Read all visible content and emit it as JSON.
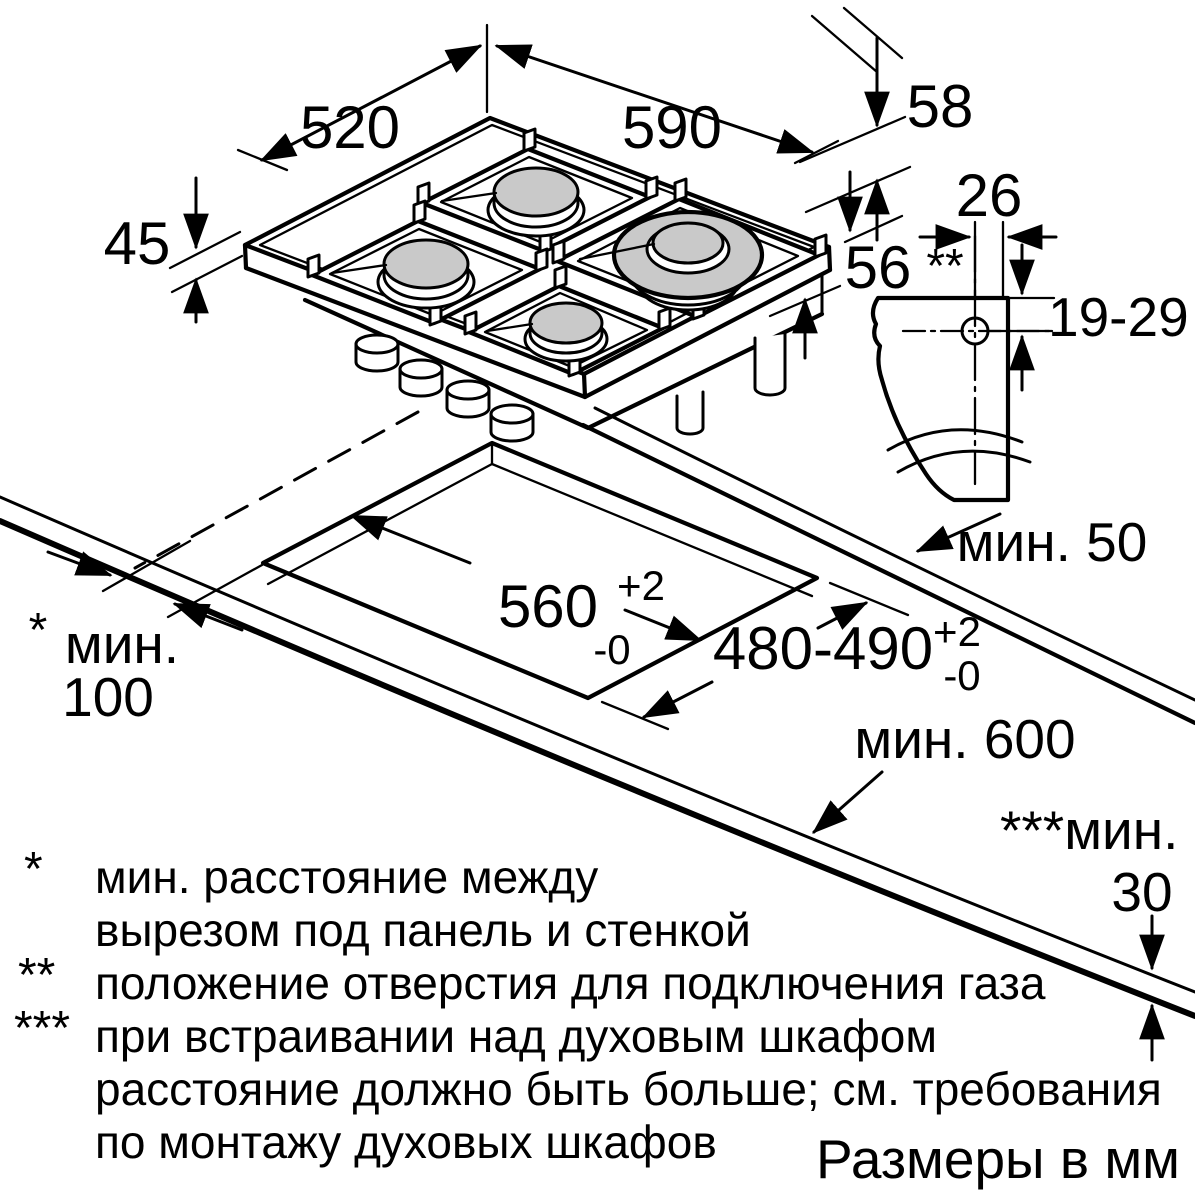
{
  "meta": {
    "units_note": "Размеры в мм"
  },
  "dimensions": {
    "hob_depth": "520",
    "hob_width": "590",
    "hob_height_above": "58",
    "hob_glass_thickness": "45",
    "hob_height_below": "56",
    "gas_connection_offset": "26",
    "gas_connection_marker": "**",
    "gas_connection_height": "19-29",
    "rear_clearance": "мин. 50",
    "cutout_width": "560",
    "cutout_width_tol_upper": "+2",
    "cutout_width_tol_lower": "-0",
    "cutout_depth": "480-490",
    "cutout_depth_tol_upper": "+2",
    "cutout_depth_tol_lower": "-0",
    "side_clearance_marker": "*",
    "side_clearance_word": "мин.",
    "side_clearance_value": "100",
    "worktop_depth": "мин. 600",
    "oven_clearance_label": "***мин.",
    "oven_clearance_value": "30"
  },
  "footnotes": {
    "f1_marker": "*",
    "f1_line1": "мин. расстояние между",
    "f1_line2": "вырезом под панель и стенкой",
    "f2_marker": "**",
    "f2_line1": "положение отверстия для подключения газа",
    "f3_marker": "***",
    "f3_line1": "при встраивании над духовым шкафом",
    "f3_line2": "расстояние должно быть больше; см. требования",
    "f3_line3": "по монтажу духовых шкафов"
  }
}
